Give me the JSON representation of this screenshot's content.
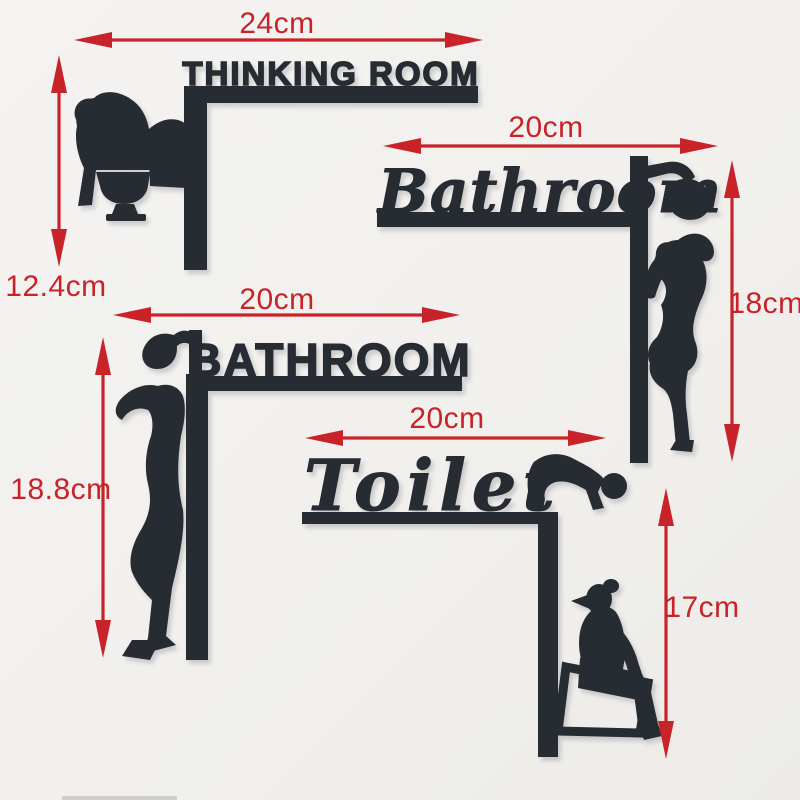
{
  "product": {
    "description_visible": "Four black acrylic door signs with red dimension arrows",
    "signs": [
      {
        "name": "THINKING ROOM",
        "style": "block",
        "figure": "thinker-sitting-on-toilet",
        "width": "24cm",
        "height": "12.4cm"
      },
      {
        "name": "Bathroom",
        "style": "script",
        "figure": "woman-showering",
        "width": "20cm",
        "height": "18cm"
      },
      {
        "name": "BATHROOM",
        "style": "block",
        "figure": "man-showering",
        "width": "20cm",
        "height": "18.8cm"
      },
      {
        "name": "Toilet",
        "style": "script",
        "figure": "crouching-man-and-woman-sitting-on-toilet",
        "width": "20cm",
        "height": "17cm"
      }
    ]
  },
  "colors": {
    "silhouette": "#272b32",
    "dimension_red": "#c9232a",
    "background": "#f1f0ed"
  }
}
